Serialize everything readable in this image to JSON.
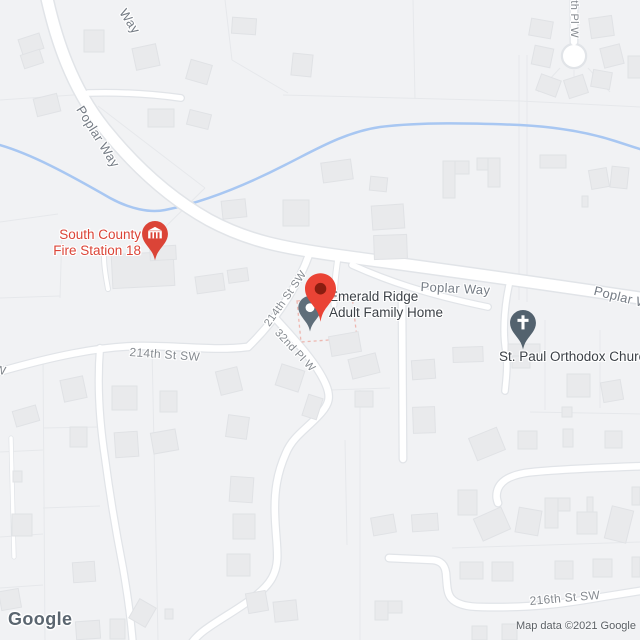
{
  "map": {
    "markers": {
      "main_place": {
        "name": "Emerald Ridge Adult Family Home",
        "label_line1": "Emerald Ridge",
        "label_line2": "Adult Family Home",
        "marker_color": "#EA4335"
      },
      "fire_station": {
        "label_line1": "South County",
        "label_line2": "Fire Station 18",
        "color": "#DB4437"
      },
      "church": {
        "label": "St. Paul Orthodox Church",
        "color": "#546572"
      }
    },
    "road_labels": {
      "way_top": "Way",
      "poplar_upper": "Poplar Way",
      "poplar_mid": "Poplar Way",
      "poplar_right": "Poplar Way",
      "st214_diag": "214th St SW",
      "st214_west": "214th St SW",
      "pl32": "32nd Pl W",
      "st216": "216th St SW",
      "pl210": "0th Pl W",
      "west_cut": "W"
    },
    "watermark": {
      "logo": "Google",
      "attribution": "Map data ©2021 Google"
    },
    "colors": {
      "background": "#F1F2F4",
      "road": "#FFFFFF",
      "road_casing": "#E1E4E8",
      "building": "#E9EAEC",
      "water": "#A8C7F2",
      "marker_red": "#EA4335",
      "marker_red_dark": "#8A1D10",
      "poi_slate": "#5F6E7A",
      "church_slate": "#53626E",
      "fire_red": "#DB4437",
      "poi_label_dark": "#3C4147",
      "road_label_gray": "#757C85"
    }
  }
}
